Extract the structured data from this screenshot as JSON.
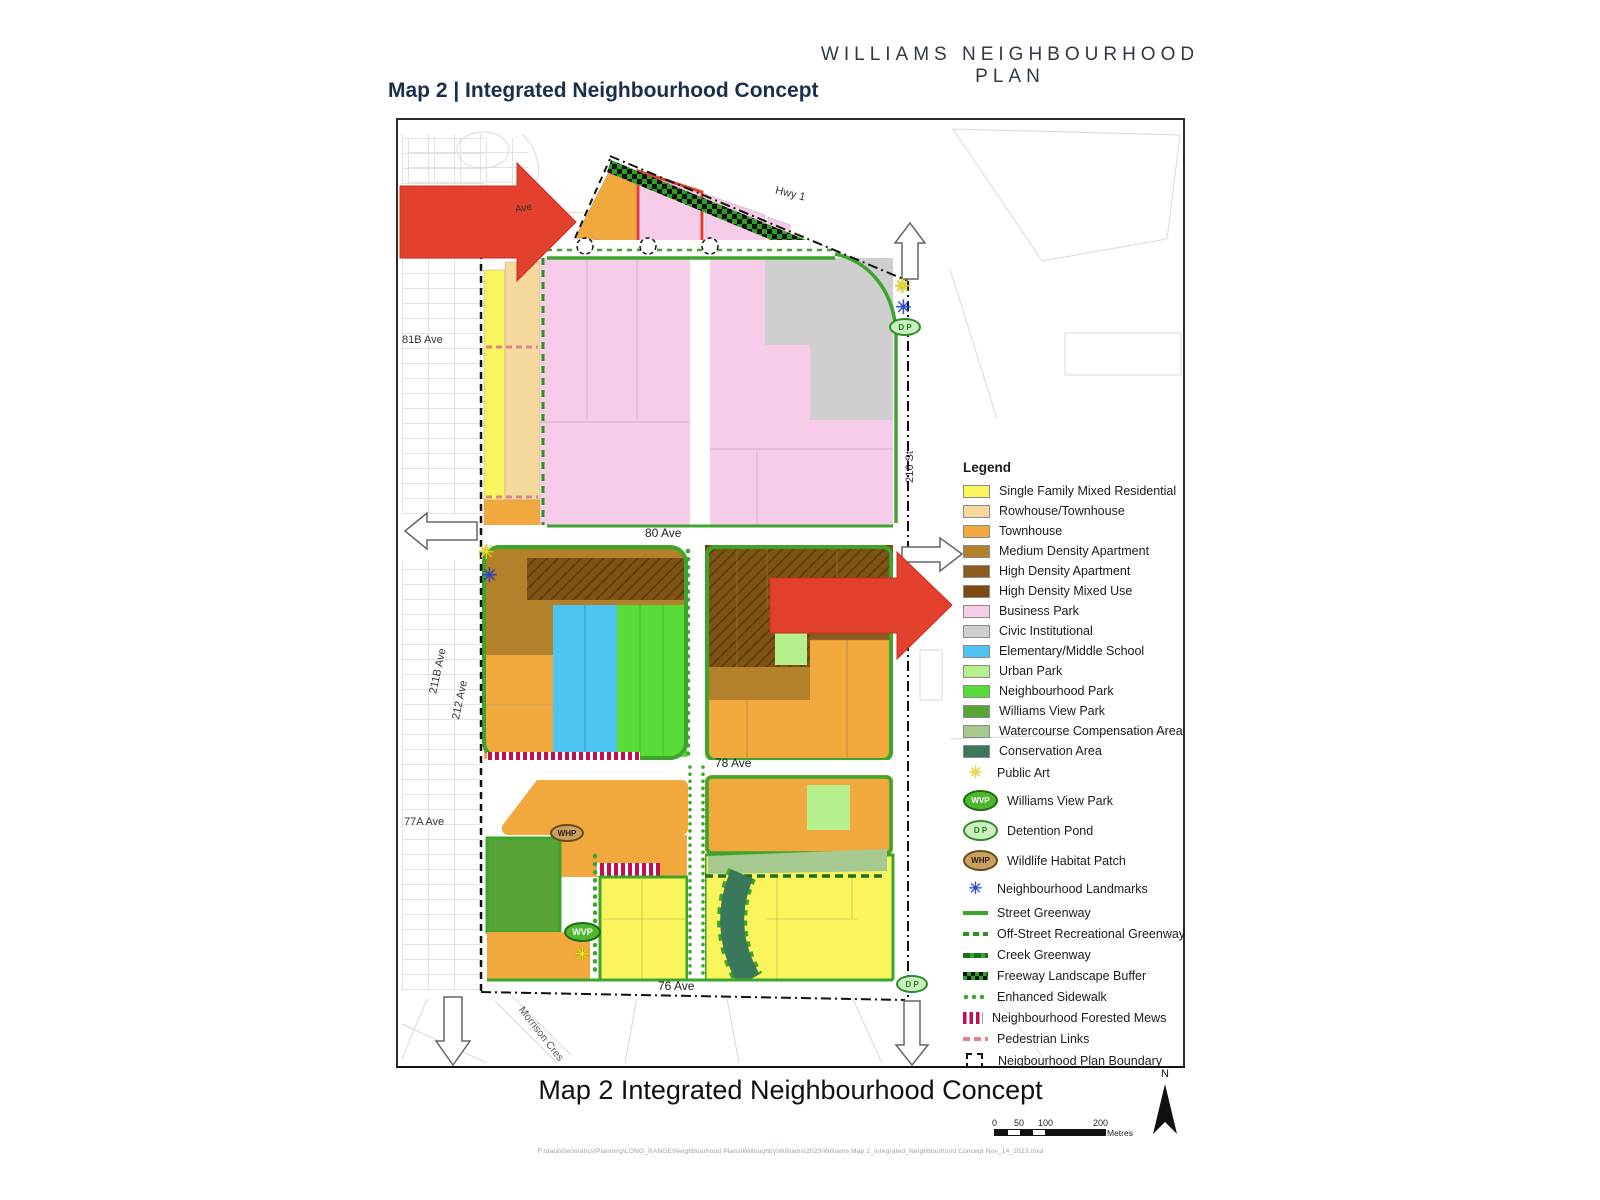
{
  "header": {
    "plan_title": "WILLIAMS NEIGHBOURHOOD PLAN",
    "map_title": "Map 2 | Integrated Neighbourhood Concept"
  },
  "map": {
    "streets": {
      "hwy_1": "Hwy 1",
      "ave_82_fragment": "Ave",
      "ave_81b": "81B Ave",
      "ave_80": "80 Ave",
      "ave_78": "78 Ave",
      "ave_77a": "77A Ave",
      "ave_76": "76 Ave",
      "ave_211b": "211B Ave",
      "ave_212": "212 Ave",
      "st_216": "216 St",
      "morrison_cres": "Morrison Cres"
    },
    "markers": {
      "public_art_icon": "✳",
      "landmark_icon": "✳",
      "wvp": "WVP",
      "dp": "D P",
      "whp": "WHP"
    },
    "colors": {
      "red_arrow": "#E4402E",
      "greenway": "#3DA52B",
      "boundary": "#111111"
    }
  },
  "legend": {
    "title": "Legend",
    "items": [
      {
        "label": "Single Family Mixed Residential",
        "swatch": "fill",
        "color": "#FAF55C"
      },
      {
        "label": "Rowhouse/Townhouse",
        "swatch": "fill",
        "color": "#F6D99C"
      },
      {
        "label": "Townhouse",
        "swatch": "fill",
        "color": "#F1A83D"
      },
      {
        "label": "Medium Density Apartment",
        "swatch": "fill",
        "color": "#B3812A"
      },
      {
        "label": "High Density Apartment",
        "swatch": "fill",
        "color": "#8D5B1F"
      },
      {
        "label": "High Density Mixed Use",
        "swatch": "fill",
        "color": "#7B4B12"
      },
      {
        "label": "Business Park",
        "swatch": "fill",
        "color": "#F7CCE8"
      },
      {
        "label": "Civic Institutional",
        "swatch": "fill",
        "color": "#CFCFCF"
      },
      {
        "label": "Elementary/Middle School",
        "swatch": "fill",
        "color": "#4EC4F2"
      },
      {
        "label": "Urban Park",
        "swatch": "fill",
        "color": "#B5F08C"
      },
      {
        "label": "Neighbourhood Park",
        "swatch": "fill",
        "color": "#58DD38"
      },
      {
        "label": "Williams View Park",
        "swatch": "fill",
        "color": "#58A437"
      },
      {
        "label": "Watercourse Compensation Area",
        "swatch": "fill",
        "color": "#A5C98E"
      },
      {
        "label": "Conservation Area",
        "swatch": "fill",
        "color": "#39785A"
      },
      {
        "label": "Public Art",
        "swatch": "star",
        "color": "#F2E33B"
      },
      {
        "label": "Williams View Park",
        "swatch": "oval",
        "text": "WVP",
        "color": "#4DB82E",
        "text_color": "#FFFFFF",
        "border": "#1F6A12"
      },
      {
        "label": "Detention Pond",
        "swatch": "oval",
        "text": "D P",
        "color": "#CDEFC0",
        "text_color": "#128512",
        "border": "#2E8B2E"
      },
      {
        "label": "Wildlife Habitat Patch",
        "swatch": "oval",
        "text": "WHP",
        "color": "#C8A060",
        "text_color": "#2F1E05",
        "border": "#6B4A1A"
      },
      {
        "label": "Neighbourhood Landmarks",
        "swatch": "asterisk",
        "color": "#2447D6"
      },
      {
        "label": "Street Greenway",
        "swatch": "line-solid",
        "color": "#3DA52B"
      },
      {
        "label": "Off-Street Recreational Greenway",
        "swatch": "line-dashed",
        "color": "#2F8F1F"
      },
      {
        "label": "Creek Greenway",
        "swatch": "line-creek",
        "color": "#1F6E1F"
      },
      {
        "label": "Freeway Landscape Buffer",
        "swatch": "checker",
        "color": "#111111"
      },
      {
        "label": "Enhanced Sidewalk",
        "swatch": "dots",
        "color": "#3DA52B"
      },
      {
        "label": "Neighbourhood Forested Mews",
        "swatch": "mews",
        "color": "#C2104F"
      },
      {
        "label": "Pedestrian Links",
        "swatch": "ped",
        "color": "#E2808F"
      },
      {
        "label": "Neigbourhood Plan Boundary",
        "swatch": "boundary",
        "color": "#111111"
      }
    ]
  },
  "footer": {
    "title": "Map 2 Integrated Neighbourhood Concept",
    "scale_ticks": [
      "0",
      "50",
      "100",
      "200"
    ],
    "scale_unit": "Metres",
    "north_label": "N",
    "file_path": "F:\\data\\Geomatics\\Planning\\LONG_RANGE\\Neighbourhood Plans\\Willoughby\\Williams\\2023\\Williams Map 2_Integrated_Neighbourhood Concept Nov_14_2023.mxd"
  }
}
